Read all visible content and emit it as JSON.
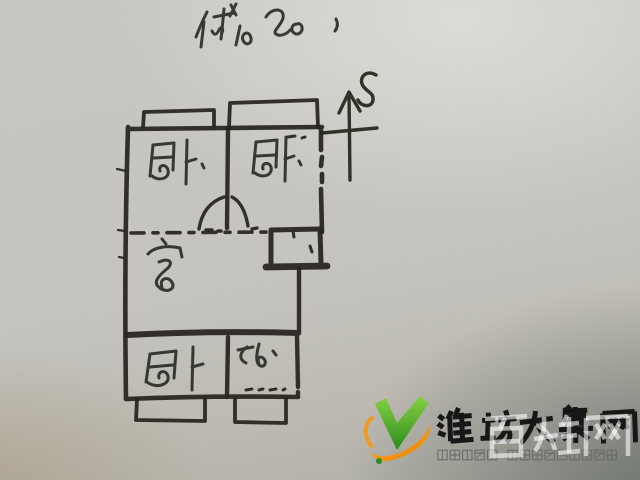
{
  "photo": {
    "annotation_top": "储 20、",
    "compass_label": "S",
    "ink_color": "#26251f",
    "paper_color": "#c7c5c0"
  },
  "floorplan": {
    "rooms": [
      {
        "id": "bedroom-northwest",
        "label": "卧"
      },
      {
        "id": "bedroom-northeast",
        "label": "卧"
      },
      {
        "id": "living-room",
        "label": "客"
      },
      {
        "id": "bedroom-south",
        "label": "卧"
      },
      {
        "id": "bathroom",
        "label": "卫"
      }
    ]
  },
  "logo": {
    "title": "潍坊大集网",
    "tagline": "潍坊信息网 潍坊百姓的网上大集",
    "watermark": "百姓网",
    "check_green": "#4fae2b",
    "check_green_dark": "#2e8c1c",
    "swoosh_orange": "#f09c1f",
    "title_color": "#171717",
    "tagline_color": "#676c66"
  }
}
